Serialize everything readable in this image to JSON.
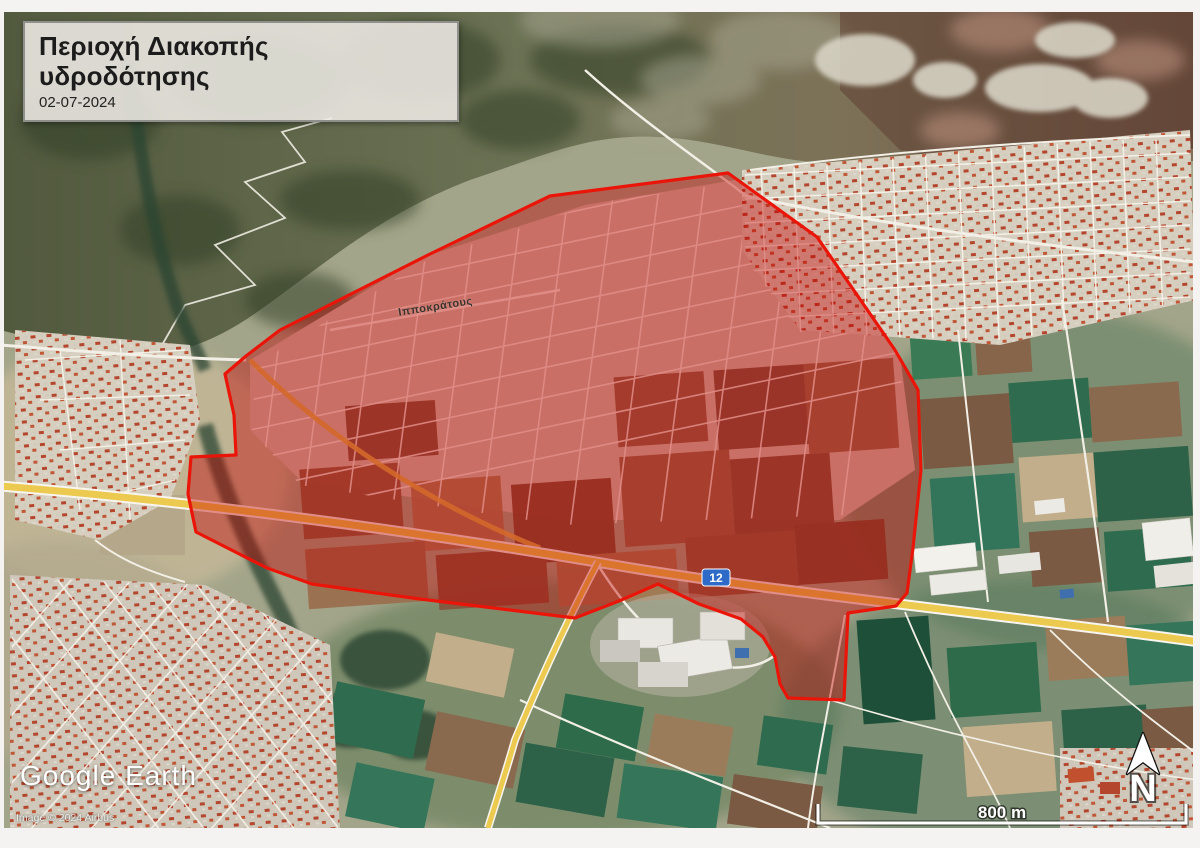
{
  "title_box": {
    "title": "Περιοχή Διακοπής υδροδότησης",
    "date": "02-07-2024"
  },
  "map": {
    "street_label": "Ιπποκράτους",
    "route_shield": "12",
    "north_label": "N",
    "scale_bar": {
      "label": "800 m"
    },
    "watermark": {
      "brand": "Google Earth",
      "attribution": "Image © 2024 Airbus"
    },
    "overlay": {
      "label": "water-outage-area",
      "polygon_points": "728,173 817,237 855,292 895,350 918,390 921,470 913,548 907,593 896,606 848,613 844,700 788,698 780,684 775,657 763,637 741,619 699,604 658,584 619,601 575,618 420,599 312,584 267,568 196,532 188,494 191,457 236,455 234,415 225,374 246,356 280,330 430,254 550,196",
      "fill_color": "#c40000",
      "fill_opacity": "0.42",
      "stroke_color": "#ea1508"
    },
    "colors": {
      "highway": "#ecc94f",
      "shield_blue": "#2e6bc8",
      "satellite_field_green": "#2e6b4a"
    }
  }
}
